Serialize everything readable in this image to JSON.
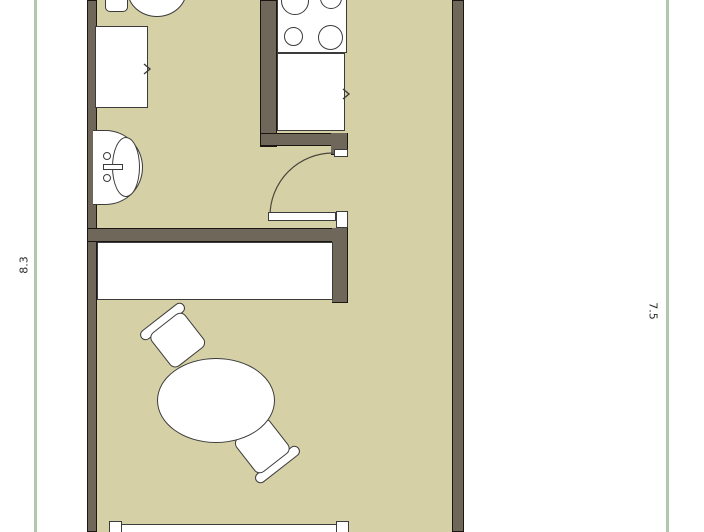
{
  "document": {
    "type": "apartment floor plan"
  },
  "dimensions": {
    "left": "8.3",
    "right": "7.5"
  },
  "colors": {
    "background": "#ffffff",
    "floor": "#d6d0a6",
    "wall": "#6f685a",
    "wall_outline": "#1a1713",
    "fixture": "#ffffff",
    "fixture_outline": "#3b3b3b",
    "boundary": "#afc7aa"
  },
  "fixtures": {
    "bathroom": [
      "toilet",
      "cabinet",
      "sink"
    ],
    "kitchen": [
      "stove",
      "counter"
    ],
    "main_room": [
      "closet",
      "dining-table",
      "chair",
      "chair",
      "bed"
    ]
  }
}
